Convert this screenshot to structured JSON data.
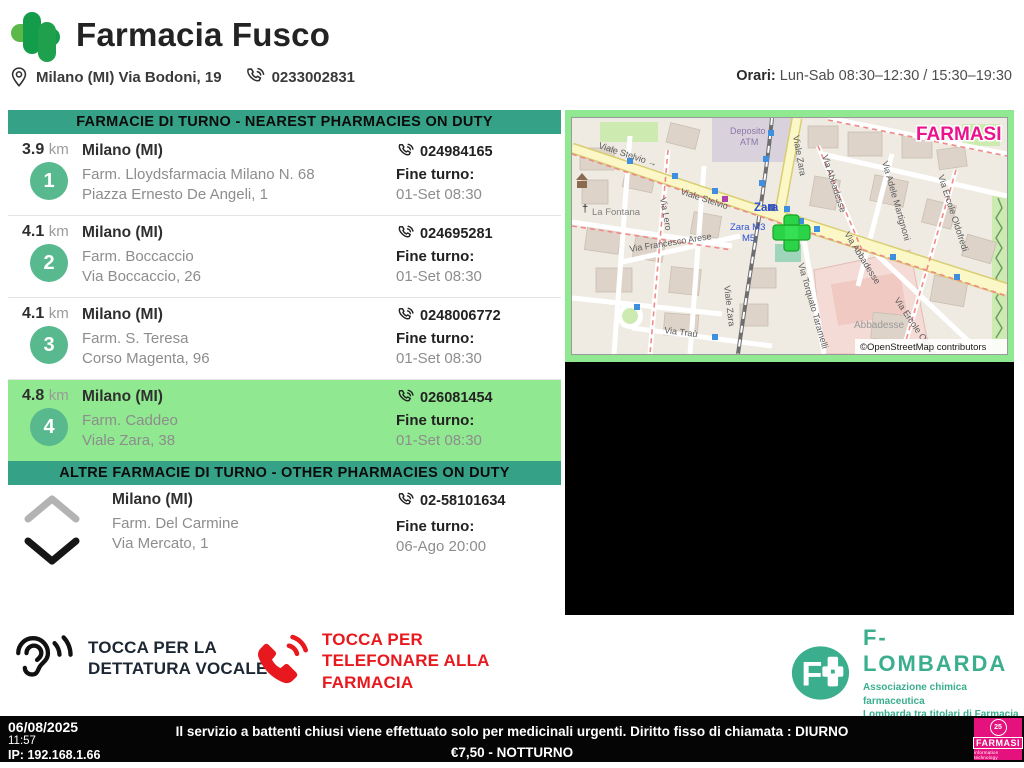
{
  "header": {
    "pharmacy_name": "Farmacia Fusco",
    "address": "Milano (MI) Via Bodoni, 19",
    "phone": "0233002831",
    "hours_label": "Orari:",
    "hours_value": "Lun-Sab 08:30–12:30 / 15:30–19:30"
  },
  "nearest": {
    "banner": "FARMACIE DI TURNO - NEAREST PHARMACIES ON DUTY",
    "items": [
      {
        "rank": "1",
        "distance": "3.9",
        "unit": "km",
        "city": "Milano (MI)",
        "name": "Farm. Lloydsfarmacia Milano N. 68",
        "street": "Piazza Ernesto De Angeli, 1",
        "phone": "024984165",
        "fine_turno_label": "Fine turno:",
        "fine_turno": "01-Set 08:30"
      },
      {
        "rank": "2",
        "distance": "4.1",
        "unit": "km",
        "city": "Milano (MI)",
        "name": "Farm. Boccaccio",
        "street": "Via Boccaccio, 26",
        "phone": "024695281",
        "fine_turno_label": "Fine turno:",
        "fine_turno": "01-Set 08:30"
      },
      {
        "rank": "3",
        "distance": "4.1",
        "unit": "km",
        "city": "Milano (MI)",
        "name": "Farm. S. Teresa",
        "street": "Corso Magenta, 96",
        "phone": "0248006772",
        "fine_turno_label": "Fine turno:",
        "fine_turno": "01-Set 08:30"
      },
      {
        "rank": "4",
        "distance": "4.8",
        "unit": "km",
        "city": "Milano (MI)",
        "name": "Farm. Caddeo",
        "street": "Viale Zara, 38",
        "phone": "026081454",
        "fine_turno_label": "Fine turno:",
        "fine_turno": "01-Set 08:30"
      }
    ]
  },
  "other": {
    "banner": "ALTRE FARMACIE DI TURNO - OTHER PHARMACIES ON DUTY",
    "item": {
      "city": "Milano (MI)",
      "name": "Farm. Del Carmine",
      "street": "Via Mercato, 1",
      "phone": "02-58101634",
      "fine_turno_label": "Fine turno:",
      "fine_turno": "06-Ago 20:00"
    }
  },
  "map": {
    "watermark": "FARMASI",
    "attribution": "©OpenStreetMap contributors",
    "station": "Zara",
    "station_line_a": "Zara M3",
    "station_line_b": "M5",
    "labels": [
      "Viale Stelvio →",
      "Viale Stelvio",
      "Viale Zara",
      "Viale Zara",
      "Deposito",
      "ATM",
      "La Fontana",
      "Via Abbadesse",
      "Via Abbadesse",
      "Via Francesco Arese",
      "Via Lero",
      "Via Torquato Taramelli",
      "Via Adele Martignoni",
      "Via Ercole Oldofredi",
      "Via Ercole Oldofredi",
      "Abbadesse",
      "Via Traù",
      "†"
    ]
  },
  "actions": {
    "voice_line1": "TOCCA PER LA",
    "voice_line2": "DETTATURA VOCALE",
    "call_line1": "TOCCA PER",
    "call_line2": "TELEFONARE ALLA",
    "call_line3": "FARMACIA"
  },
  "flombarda": {
    "name": "F-LOMBARDA",
    "tagline1": "Associazione chimica farmaceutica",
    "tagline2": "Lombarda tra titolari di Farmacia"
  },
  "statusbar": {
    "date": "06/08/2025",
    "time": "11:57",
    "ip": "IP: 192.168.1.66",
    "notice_line1": "Il servizio a battenti chiusi viene effettuato solo per medicinali urgenti. Diritto fisso di chiamata : DIURNO €7,50 - NOTTURNO",
    "notice_line2": "€10,00 (Art.9 D.M. 22/09/2017)",
    "farmasi_badge": "25",
    "farmasi_name": "FARMASI",
    "farmasi_sub": "information technology"
  }
}
